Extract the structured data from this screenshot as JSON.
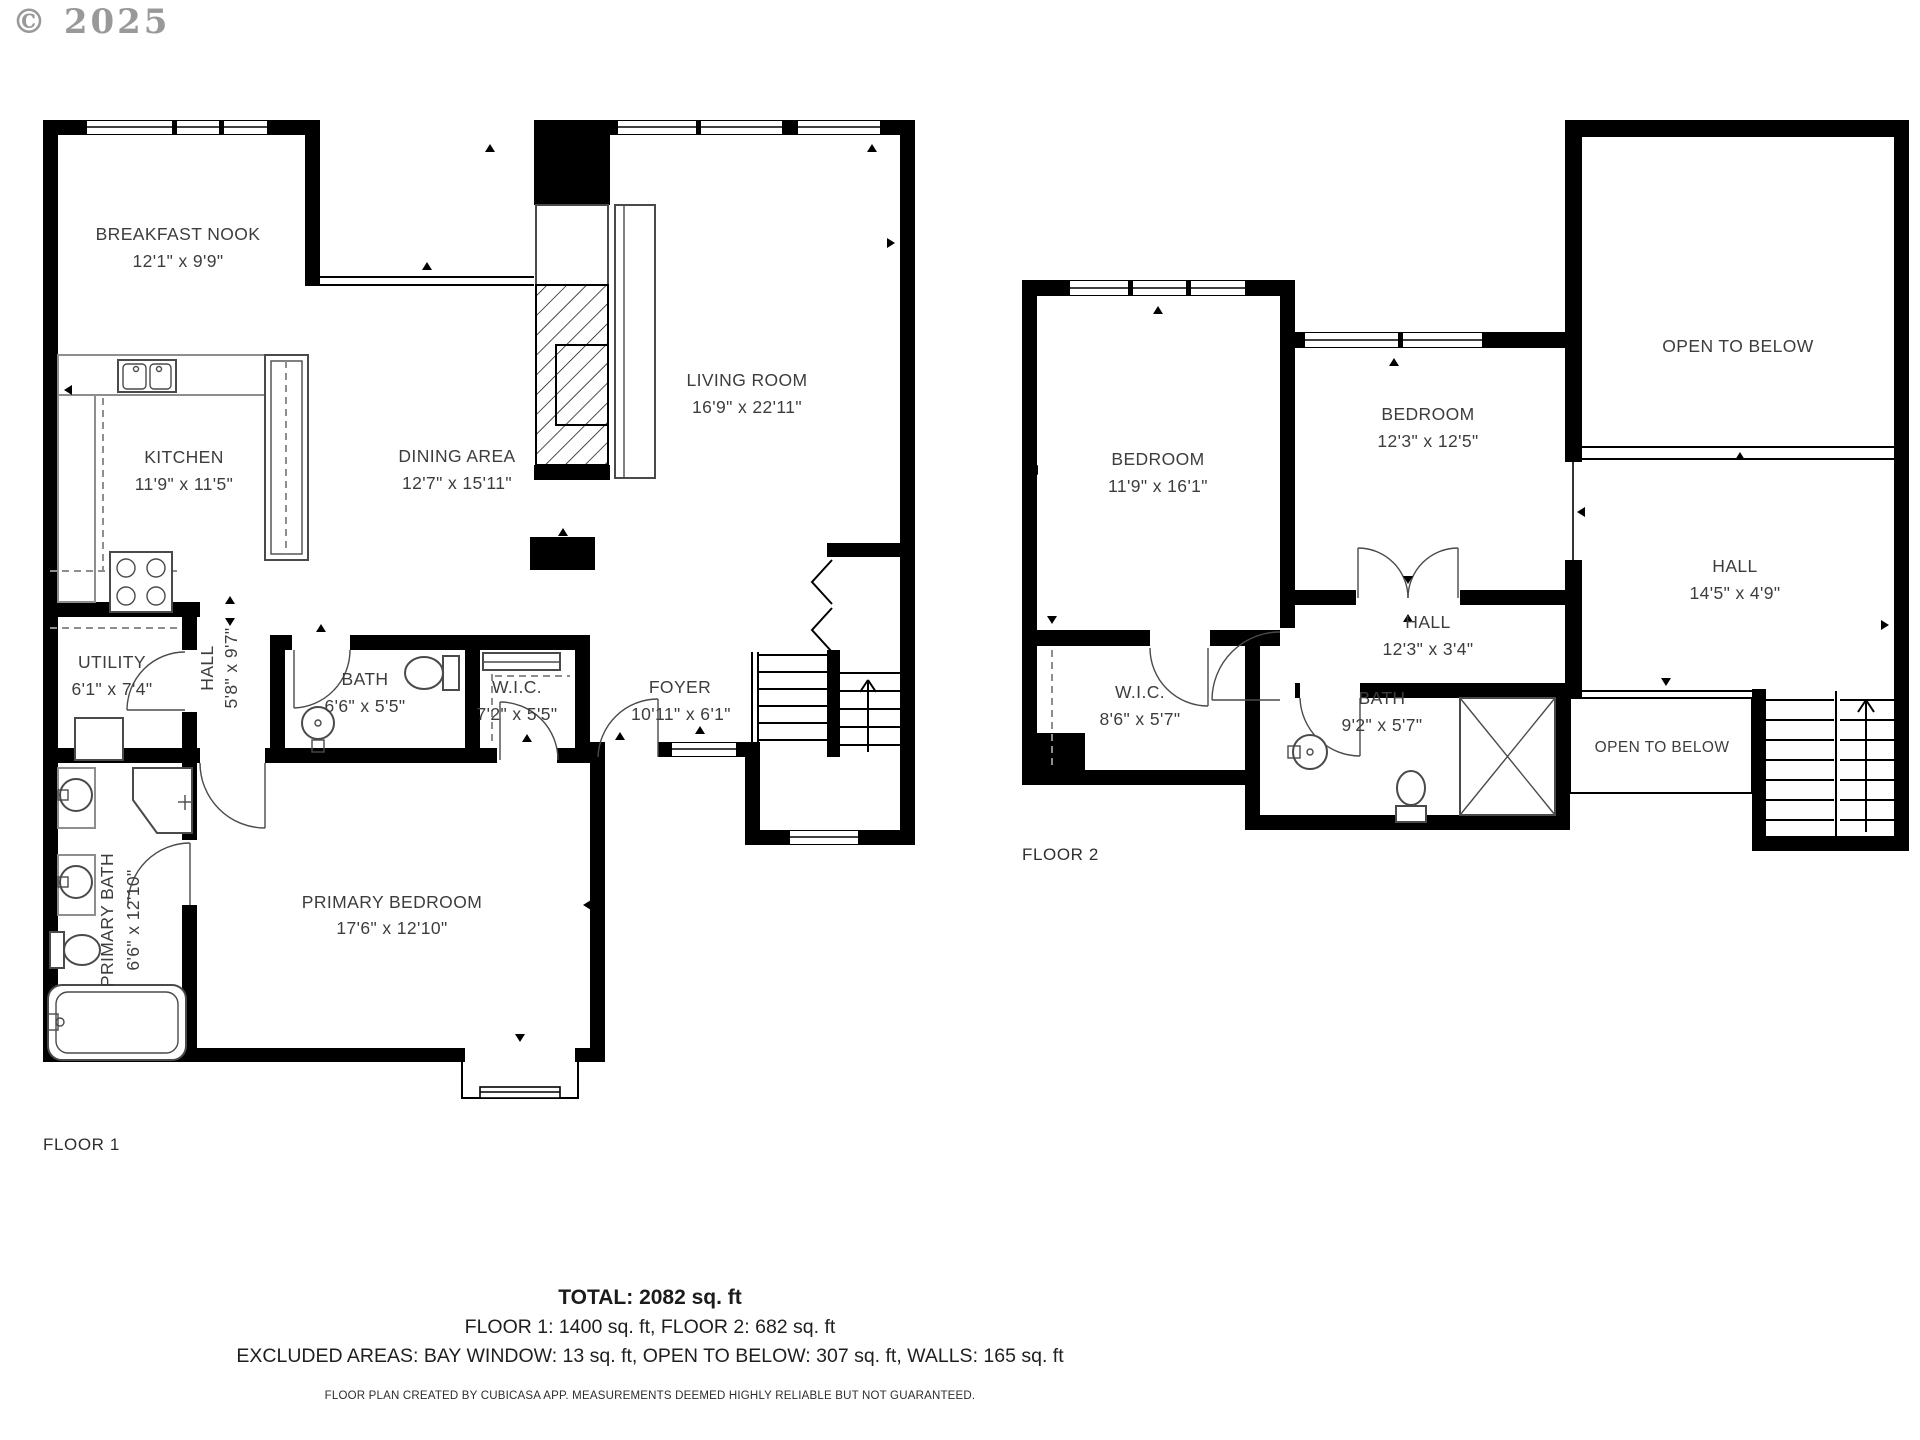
{
  "watermark": "© 2025",
  "colors": {
    "wall": "#000000",
    "label_text": "#3d3d3d",
    "watermark": "#8e8e8e",
    "fixture": "#4a4a4a"
  },
  "floor1": {
    "label": "FLOOR 1",
    "rooms": {
      "breakfast_nook": {
        "name": "BREAKFAST NOOK",
        "dims": "12'1\" x 9'9\""
      },
      "kitchen": {
        "name": "KITCHEN",
        "dims": "11'9\" x 11'5\""
      },
      "dining": {
        "name": "DINING AREA",
        "dims": "12'7\" x 15'11\""
      },
      "living": {
        "name": "LIVING ROOM",
        "dims": "16'9\" x 22'11\""
      },
      "utility": {
        "name": "UTILITY",
        "dims": "6'1\" x 7'4\""
      },
      "hall": {
        "name": "HALL",
        "dims": "5'8\" x 9'7\""
      },
      "bath": {
        "name": "BATH",
        "dims": "6'6\" x 5'5\""
      },
      "wic": {
        "name": "W.I.C.",
        "dims": "7'2\" x 5'5\""
      },
      "foyer": {
        "name": "FOYER",
        "dims": "10'11\" x 6'1\""
      },
      "primary_bath": {
        "name": "PRIMARY BATH",
        "dims": "6'6\" x 12'10\""
      },
      "primary_bedroom": {
        "name": "PRIMARY BEDROOM",
        "dims": "17'6\" x 12'10\""
      }
    }
  },
  "floor2": {
    "label": "FLOOR 2",
    "rooms": {
      "bedroom1": {
        "name": "BEDROOM",
        "dims": "11'9\" x 16'1\""
      },
      "bedroom2": {
        "name": "BEDROOM",
        "dims": "12'3\" x 12'5\""
      },
      "open_below_large": {
        "name": "OPEN TO BELOW"
      },
      "hall_left": {
        "name": "HALL",
        "dims": "12'3\" x 3'4\""
      },
      "hall_right": {
        "name": "HALL",
        "dims": "14'5\" x 4'9\""
      },
      "wic": {
        "name": "W.I.C.",
        "dims": "8'6\" x 5'7\""
      },
      "bath": {
        "name": "BATH",
        "dims": "9'2\" x 5'7\""
      },
      "open_below_small": {
        "name": "OPEN TO BELOW"
      }
    }
  },
  "summary": {
    "total": "TOTAL: 2082 sq. ft",
    "floors": "FLOOR 1: 1400 sq. ft, FLOOR 2: 682 sq. ft",
    "excluded": "EXCLUDED AREAS: BAY WINDOW: 13 sq. ft, OPEN TO BELOW: 307 sq. ft, WALLS: 165 sq. ft",
    "footer": "FLOOR PLAN CREATED BY CUBICASA APP. MEASUREMENTS DEEMED HIGHLY RELIABLE BUT NOT GUARANTEED."
  }
}
